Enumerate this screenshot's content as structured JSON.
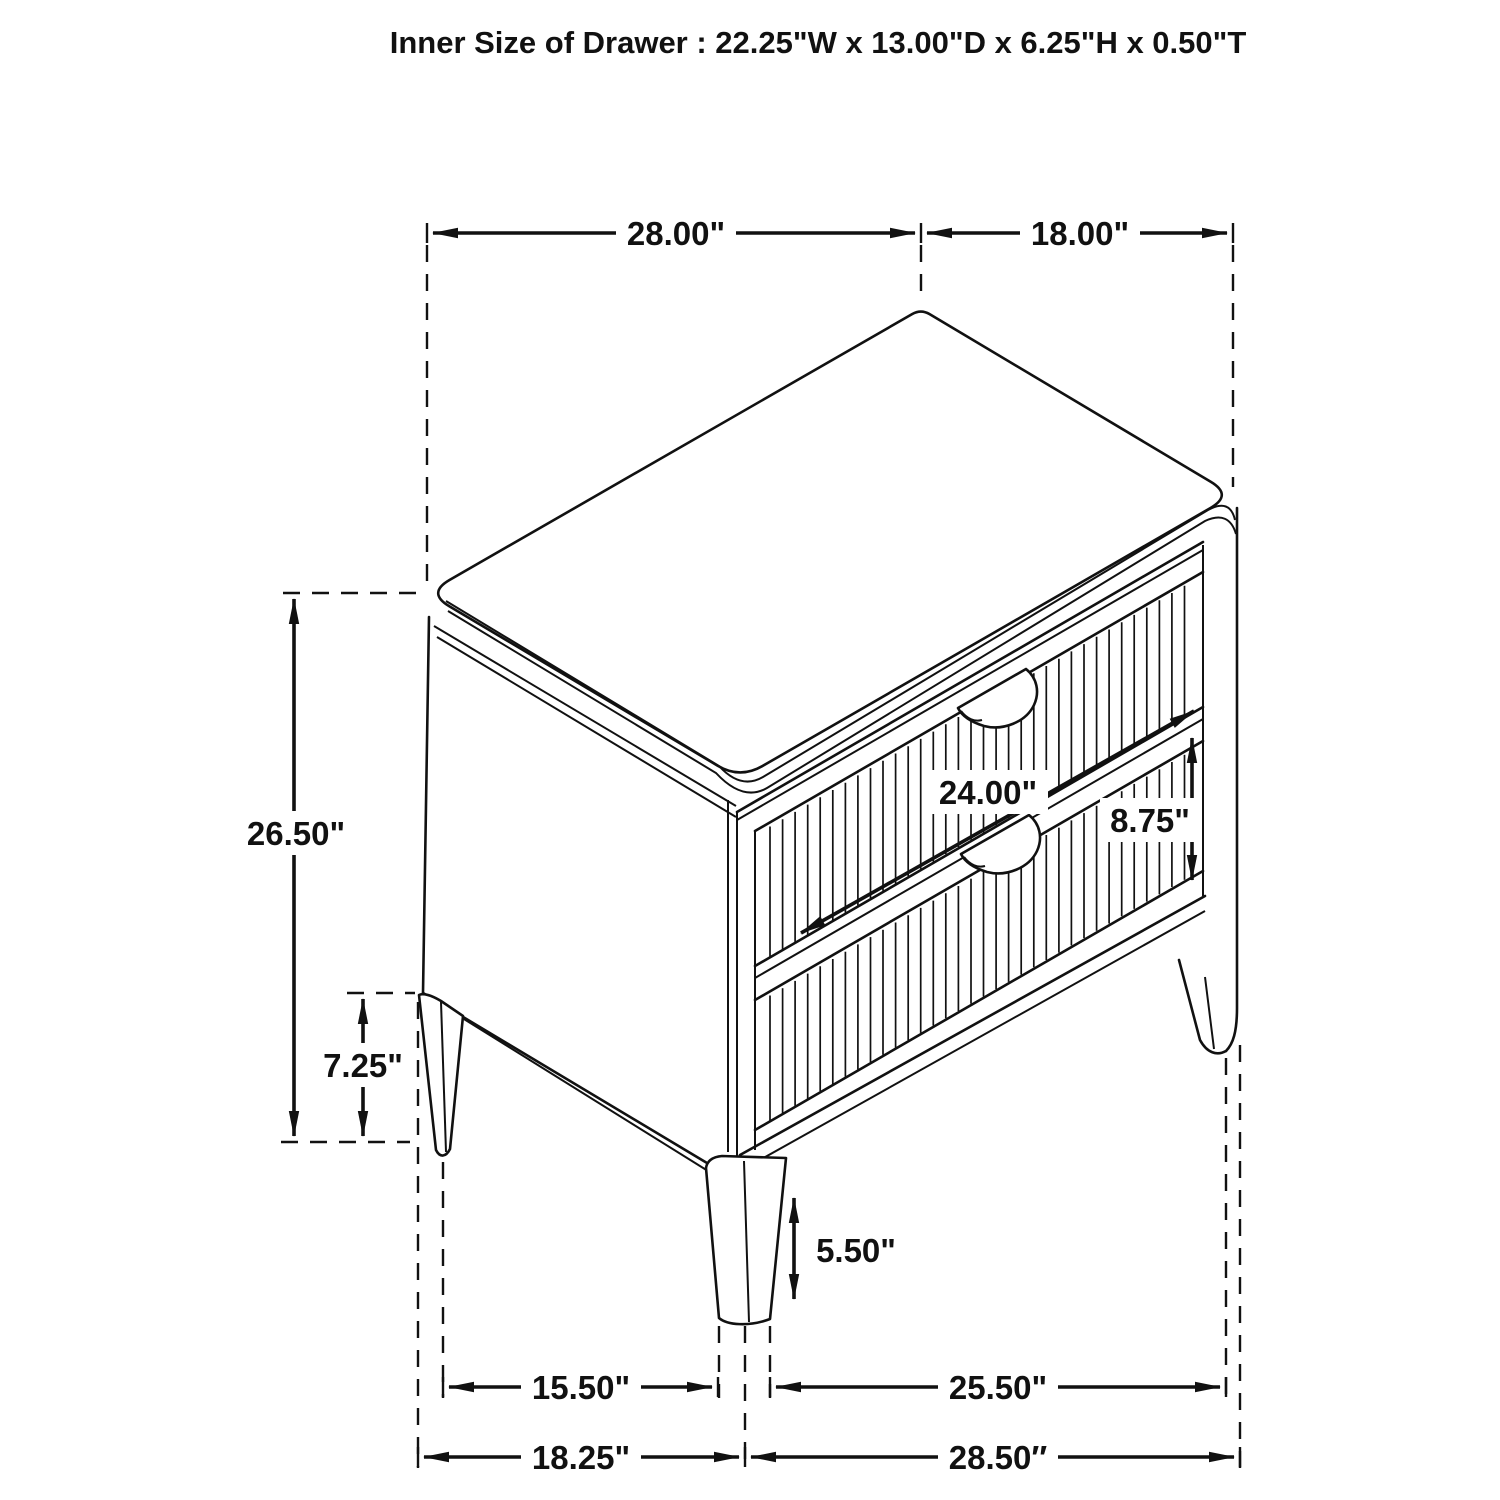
{
  "title": "Inner Size of Drawer : 22.25\"W x 13.00\"D x 6.25\"H x 0.50\"T",
  "dimensions": {
    "top_width": "28.00\"",
    "top_depth": "18.00\"",
    "overall_height": "26.50\"",
    "rear_leg_height": "7.25\"",
    "drawer_width": "24.00\"",
    "drawer_front_height": "8.75\"",
    "front_leg_height": "5.50\"",
    "leg_span_side": "15.50\"",
    "leg_span_front": "25.50\"",
    "base_depth": "18.25\"",
    "base_width": "28.50″"
  },
  "figure": {
    "type": "technical-line-drawing",
    "subject": "two-drawer-nightstand",
    "line_color": "#111111",
    "background_color": "#ffffff"
  }
}
